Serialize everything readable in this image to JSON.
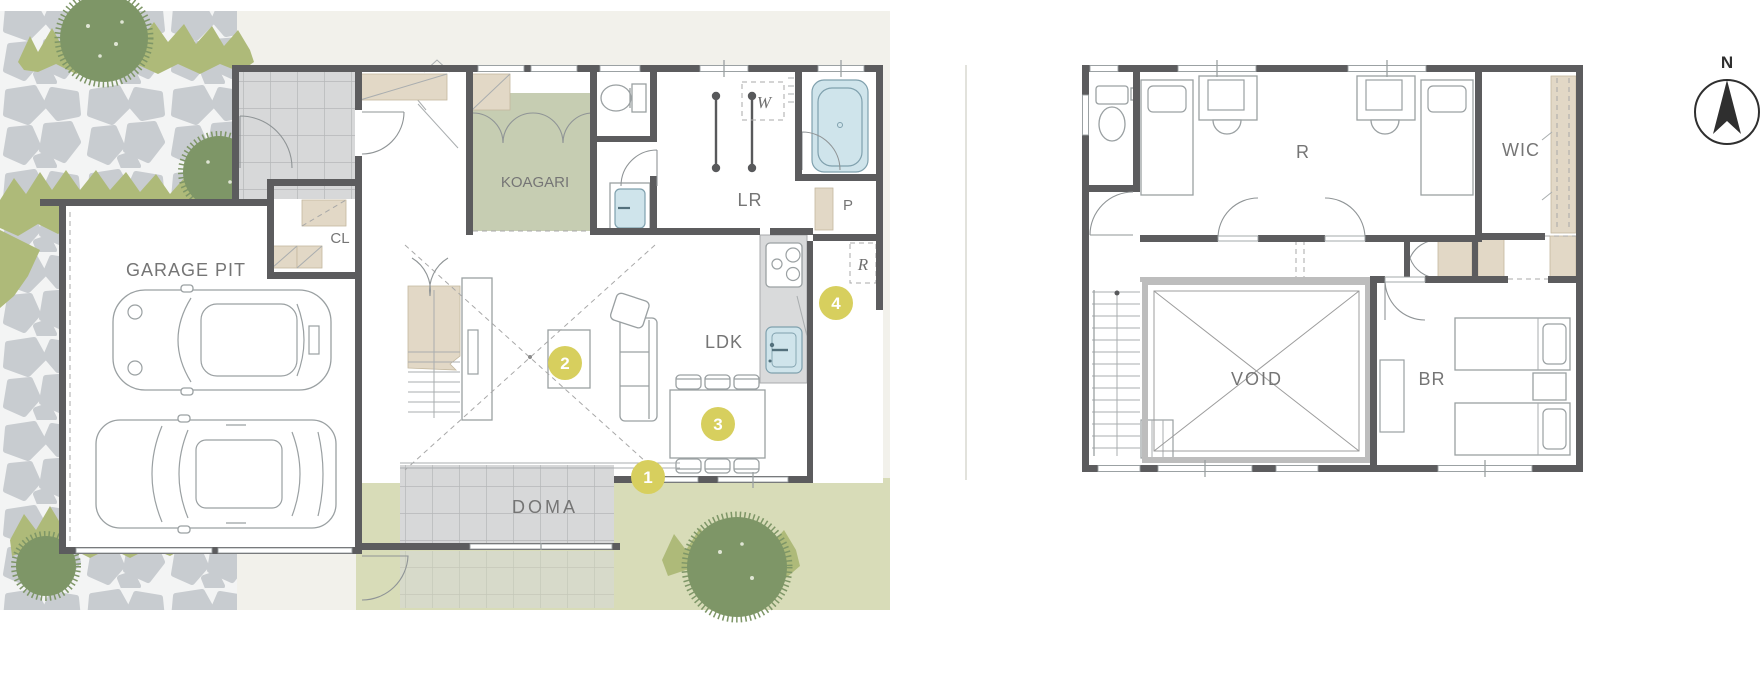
{
  "floor1": {
    "labels": {
      "garage": "GARAGE PIT",
      "closet": "CL",
      "koagari": "KOAGARI",
      "laundry": "LR",
      "washer": "W",
      "pantry": "P",
      "fridge": "R",
      "ldk": "LDK",
      "doma": "DOMA"
    },
    "markers": [
      {
        "number": "1"
      },
      {
        "number": "2"
      },
      {
        "number": "3"
      },
      {
        "number": "4"
      }
    ]
  },
  "floor2": {
    "labels": {
      "room": "R",
      "wic": "WIC",
      "void": "VOID",
      "bedroom": "BR"
    }
  },
  "compass": {
    "north": "N"
  },
  "colors": {
    "marker": "#d7cf5e",
    "wall": "#5c5c5e",
    "tatami": "#c6cdb2",
    "beige": "#e2d8c6",
    "lawn": "#d8dcb8",
    "water": "#cfe4eb",
    "site": "#f2f1eb",
    "tree": "#7e9667"
  }
}
